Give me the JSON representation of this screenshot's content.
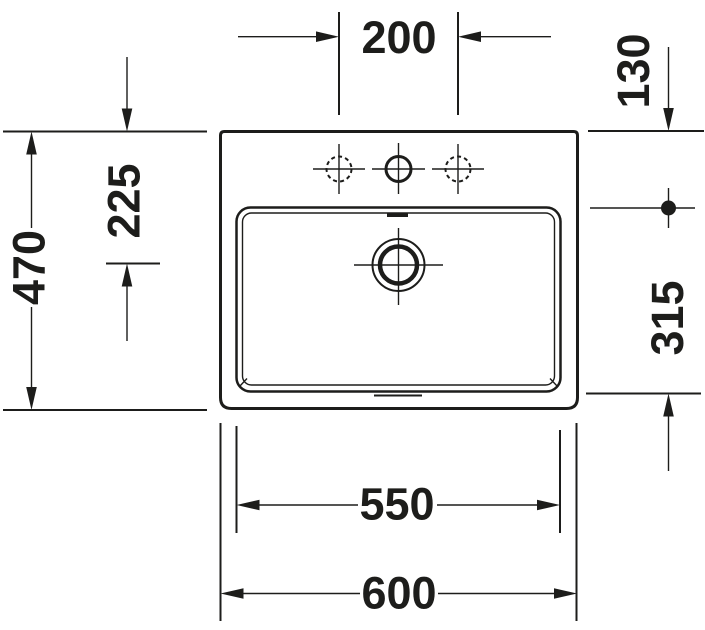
{
  "diagram": {
    "type": "technical-drawing",
    "subject": "rectangular washbasin with three tap holes, top view, dimensions in mm",
    "colors": {
      "line": "#1d1d1b",
      "background": "#ffffff"
    },
    "labels": {
      "tap_hole_spacing": "200",
      "back_edge_to_tap_line": "130",
      "back_edge_to_drain": "225",
      "overall_depth": "470",
      "bowl_front_to_back": "315",
      "bowl_width": "550",
      "overall_width": "600"
    }
  }
}
